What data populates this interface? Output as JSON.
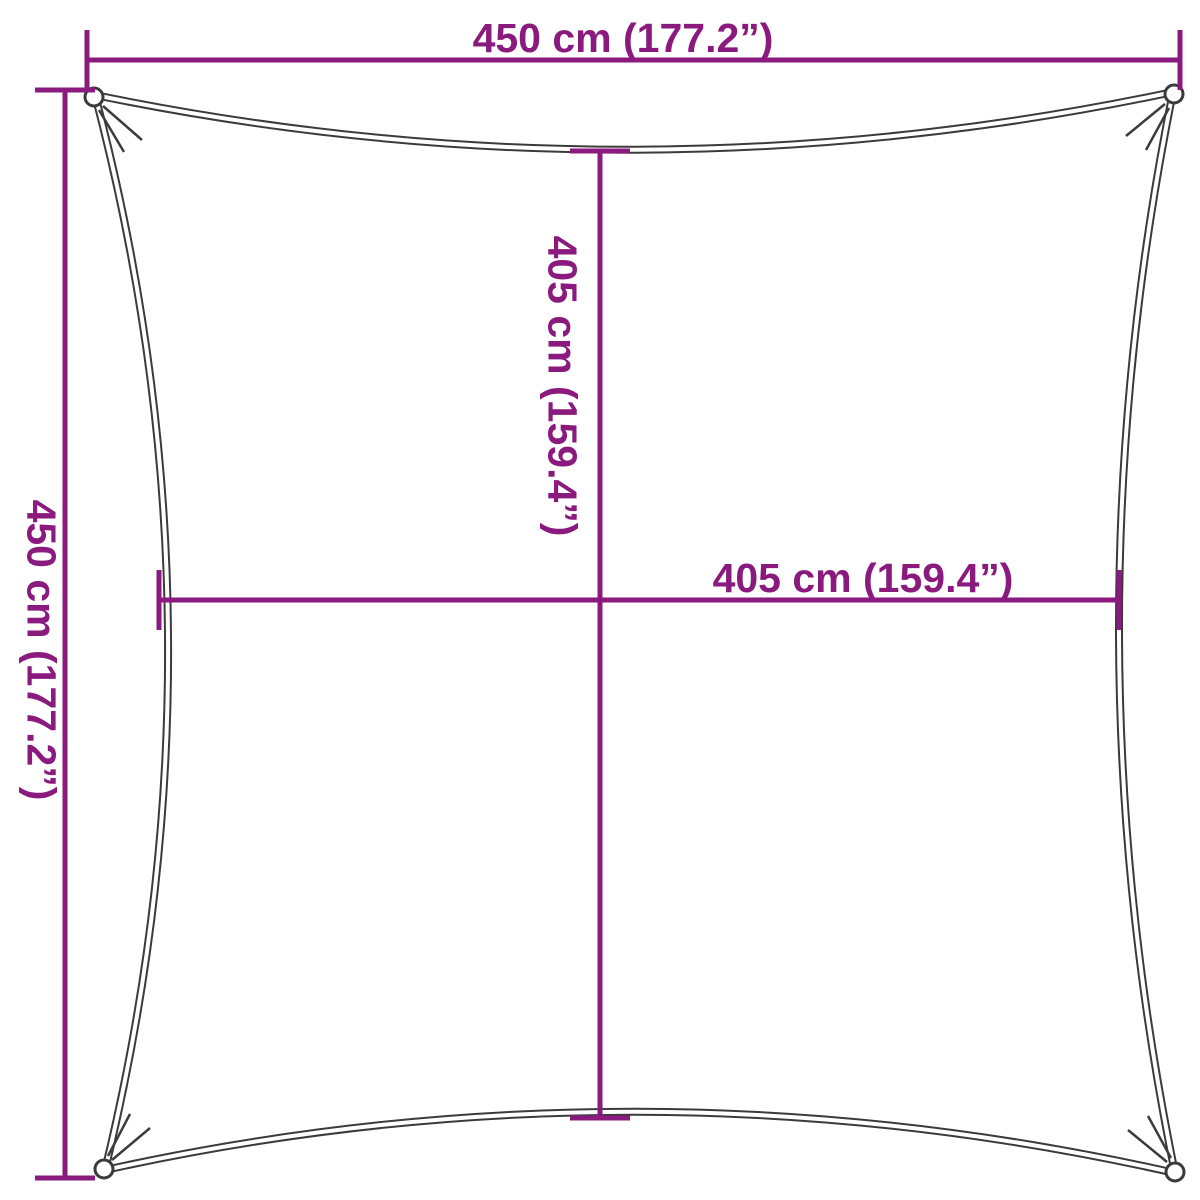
{
  "diagram": {
    "type": "product-dimension-diagram",
    "subject": "square shade sail with concave edges and corner grommets",
    "colors": {
      "dimension_lines": "#8A1A7E",
      "sail_outline": "#3B3B3B",
      "background": "#FFFFFF"
    },
    "labels": {
      "top_width": "450 cm (177.2”)",
      "left_height": "450 cm (177.2”)",
      "inner_height": "405 cm (159.4”)",
      "inner_width": "405 cm (159.4”)"
    }
  }
}
